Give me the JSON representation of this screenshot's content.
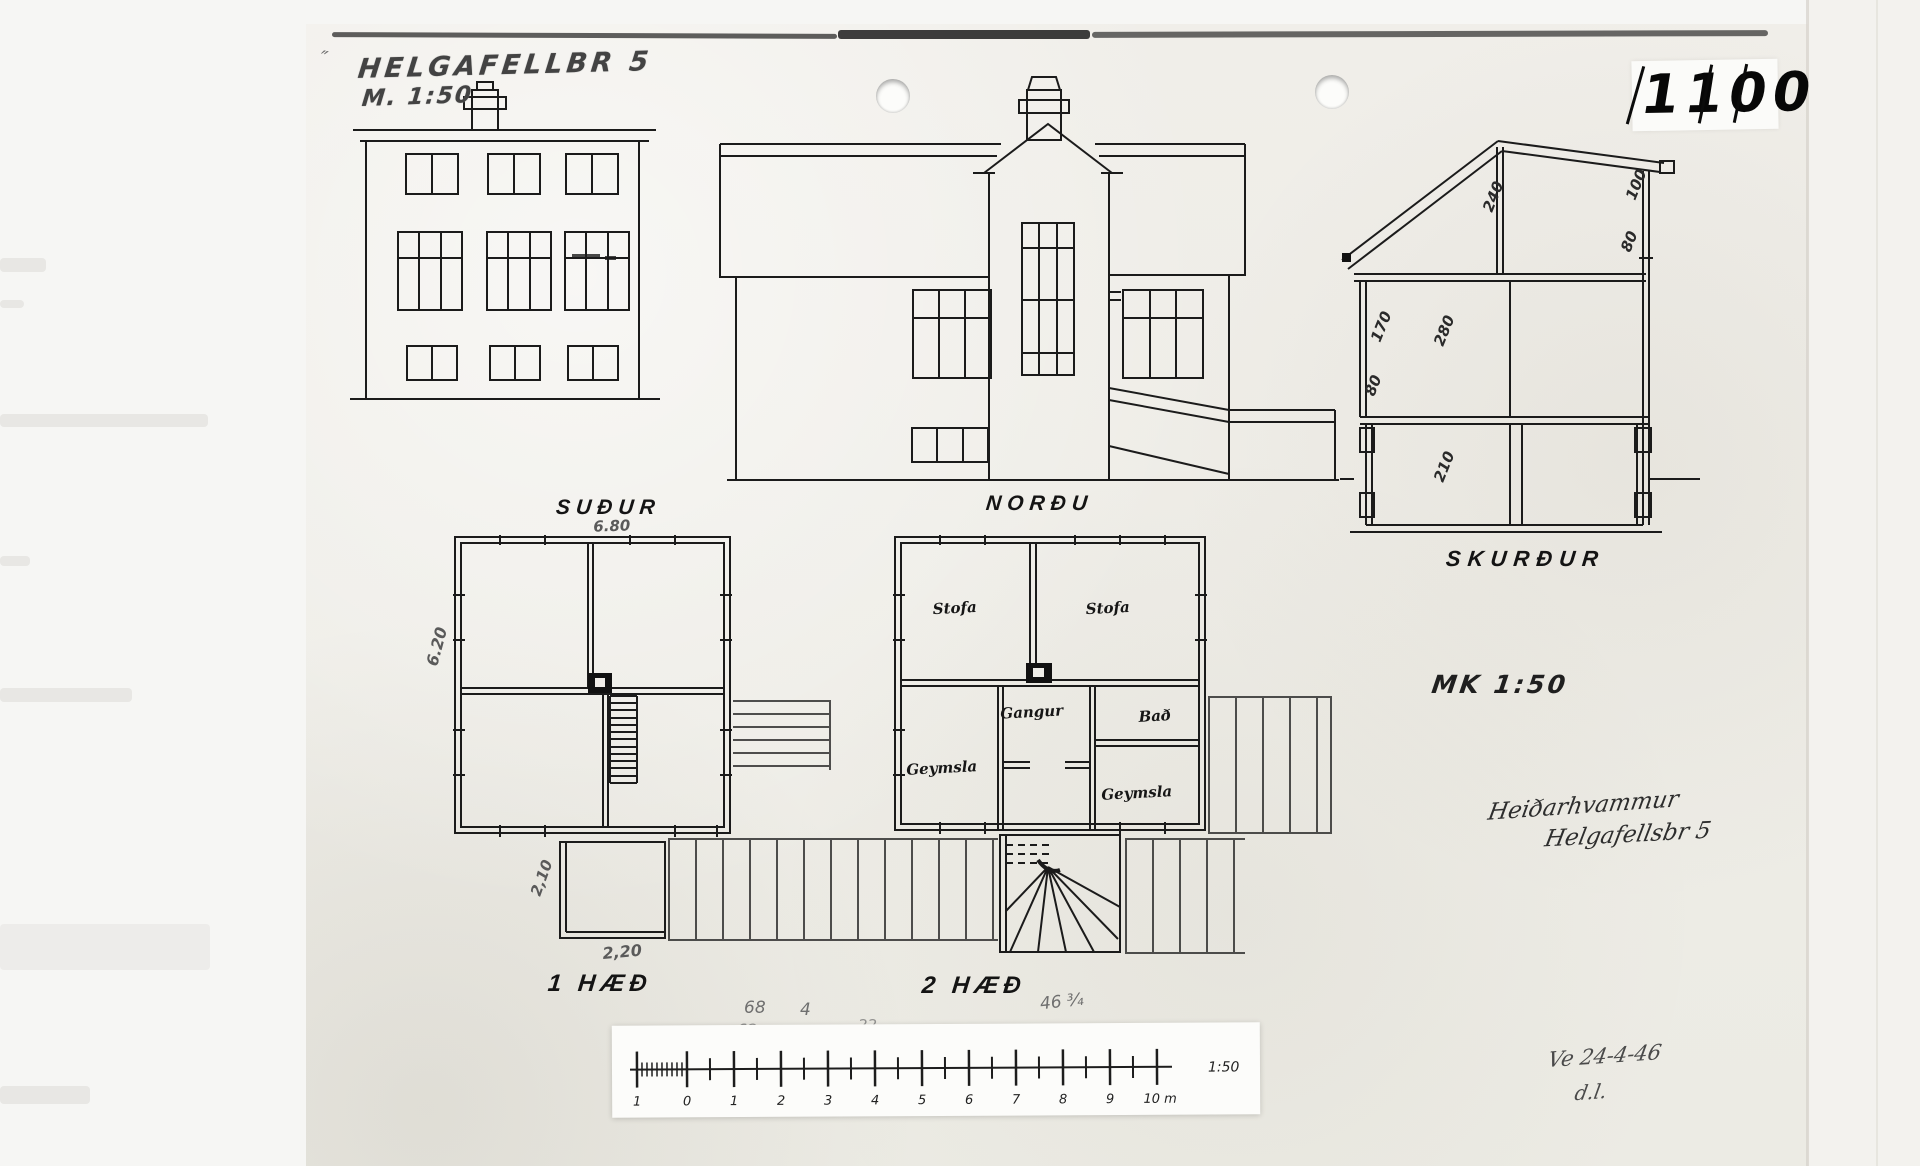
{
  "colors": {
    "paper": "#efede8",
    "ink": "#1b1b1b",
    "pencil": "#6f6f6f"
  },
  "artifact": {
    "stamp_number": "1100",
    "title_mark": "″",
    "title_street": "HELGAFELLBR 5",
    "title_scale": "M. 1:50",
    "scale_note": "MK 1:50"
  },
  "view_labels": {
    "south": "SUÐUR",
    "north": "NORÐU",
    "section": "SKURÐUR",
    "floor1": "1 HÆÐ",
    "floor2": "2 HÆÐ"
  },
  "floor1_dims": {
    "width_top": "6.80",
    "depth_left": "6.20",
    "porch_depth": "2,10",
    "porch_width": "2,20"
  },
  "floor2_rooms": {
    "stofa_left": "Stofa",
    "stofa_right": "Stofa",
    "gangur": "Gangur",
    "bad": "Bað",
    "geymsla_left": "Geymsla",
    "geymsla_right": "Geymsla"
  },
  "section_dims": {
    "attic_height": "240",
    "roof_right_top": "100",
    "roof_right_low": "80",
    "upper_left": "170",
    "upper_room_height": "280",
    "lower_left": "80",
    "basement_height": "210"
  },
  "scale_bar": {
    "ticks": [
      "1",
      "0",
      "1",
      "2",
      "3",
      "4",
      "5",
      "6",
      "7",
      "8",
      "9",
      "10 m"
    ],
    "ratio": "1:50"
  },
  "pencil_notes": {
    "left_top": "68",
    "left_top2": "4",
    "left_bottom": "62",
    "middle": "22",
    "right": "46 ¾"
  },
  "handwriting": {
    "farm_name": "Heiðarhvammur",
    "street": "Helgafellsbr 5",
    "date": "Ve 24-4-46",
    "initials": "d.l."
  }
}
